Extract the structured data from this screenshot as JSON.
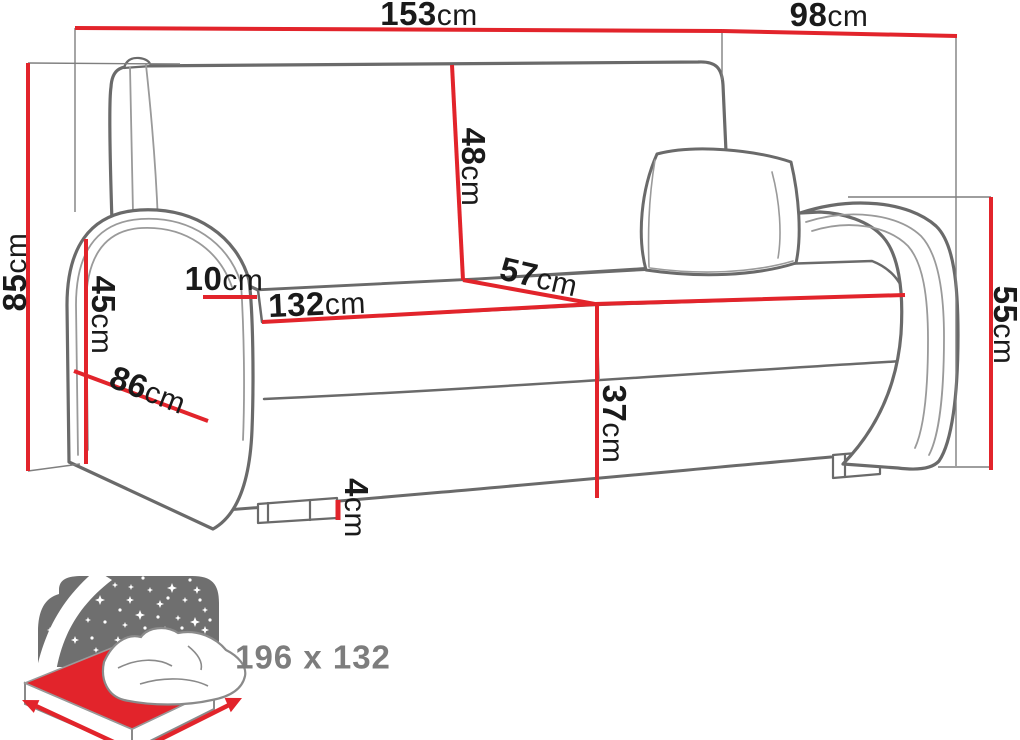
{
  "diagram_type": "sofa-dimension-diagram",
  "unit": "cm",
  "colors": {
    "dimension_red": "#e2242b",
    "sofa_outline_gray": "#6a6a6a",
    "seam_gray": "#9a9a9a",
    "construction_gray": "#7f7f7f",
    "label_black": "#1a1a1a",
    "icon_sky_gray": "#6f6f6f",
    "icon_text_gray": "#7d7d7d"
  },
  "dimensions": {
    "overall_width": {
      "value": "153",
      "unit": "cm"
    },
    "overall_depth": {
      "value": "98",
      "unit": "cm"
    },
    "overall_height": {
      "value": "85",
      "unit": "cm"
    },
    "armrest_height": {
      "value": "45",
      "unit": "cm"
    },
    "armrest_width": {
      "value": "10",
      "unit": "cm"
    },
    "seat_width": {
      "value": "132",
      "unit": "cm"
    },
    "backrest_height": {
      "value": "48",
      "unit": "cm"
    },
    "seat_depth": {
      "value": "57",
      "unit": "cm"
    },
    "seat_height": {
      "value": "37",
      "unit": "cm"
    },
    "leg_height": {
      "value": "4",
      "unit": "cm"
    },
    "arm_outer_height": {
      "value": "55",
      "unit": "cm"
    },
    "arm_depth": {
      "value": "86",
      "unit": "cm"
    }
  },
  "sleep_function": {
    "icon": "bed-night-stars-icon",
    "bed_size": "196 x 132"
  }
}
